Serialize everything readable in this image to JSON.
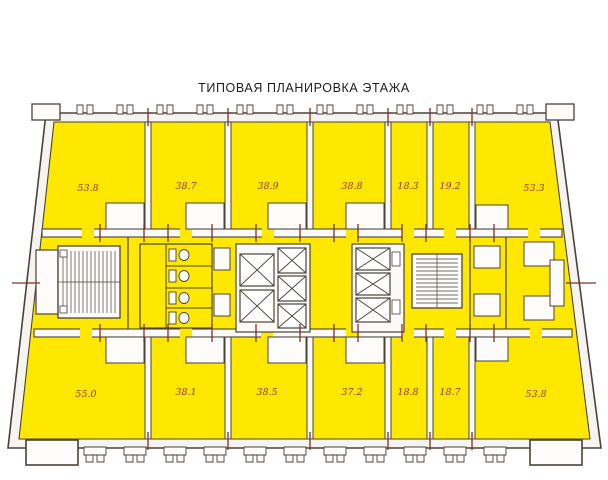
{
  "title": "ТИПОВАЯ ПЛАНИРОВКА ЭТАЖА",
  "colors": {
    "room_fill": "#FFE800",
    "wall_line": "#4A423A",
    "area_label": "#9B3126",
    "tick_mark": "#803026"
  },
  "rooms": {
    "top": [
      {
        "area": "53.8"
      },
      {
        "area": "38.7"
      },
      {
        "area": "38.9"
      },
      {
        "area": "38.8"
      },
      {
        "area": "18.3"
      },
      {
        "area": "19.2"
      },
      {
        "area": "53.3"
      }
    ],
    "bottom": [
      {
        "area": "55.0"
      },
      {
        "area": "38.1"
      },
      {
        "area": "38.5"
      },
      {
        "area": "37.2"
      },
      {
        "area": "18.8"
      },
      {
        "area": "18.7"
      },
      {
        "area": "53.8"
      }
    ]
  },
  "symbols": {
    "elevator": "crossed-square",
    "stairs": "hatched-block",
    "wc": "toilet-fixtures"
  }
}
